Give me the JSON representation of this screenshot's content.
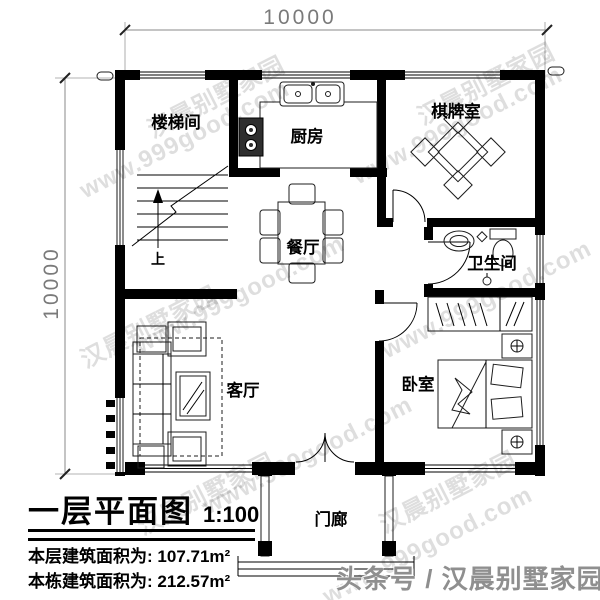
{
  "dimensions": {
    "top": "10000",
    "left": "10000"
  },
  "rooms": {
    "stairwell": "楼梯间",
    "kitchen": "厨房",
    "chess": "棋牌室",
    "dining": "餐厅",
    "bathroom": "卫生间",
    "living": "客厅",
    "bedroom": "卧室",
    "porch": "门廊"
  },
  "stairs": {
    "up": "上"
  },
  "title_block": {
    "title": "一层平面图",
    "scale": "1:100",
    "floor_area_label": "本层建筑面积为:",
    "floor_area_value": "107.71m²",
    "total_area_label": "本栋建筑面积为:",
    "total_area_value": "212.57m²"
  },
  "watermarks": {
    "site": "www.999good.com",
    "brand": "汉晨别墅家园",
    "footer": "头条号 / 汉晨别墅家园"
  },
  "colors": {
    "wall": "#000000",
    "dim_text": "#7a7a7a",
    "watermark": "rgba(0,0,0,0.13)",
    "footer_text": "#8f8f8f"
  }
}
